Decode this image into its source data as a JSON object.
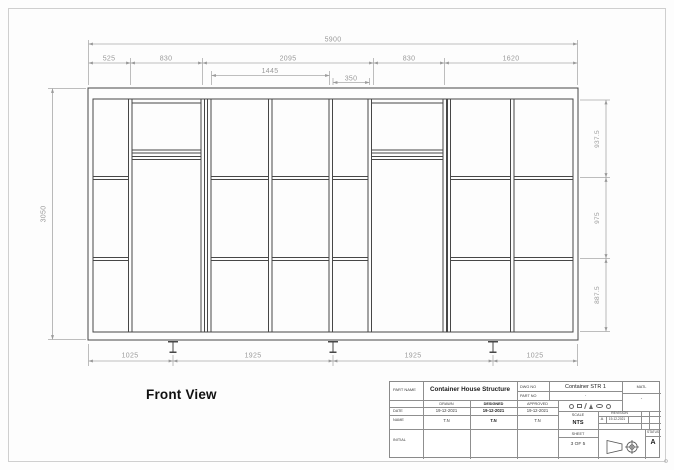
{
  "view": {
    "label": "Front View"
  },
  "dimensions": {
    "top_total": "5900",
    "top_segments": [
      "525",
      "830",
      "2095",
      "830",
      "1620"
    ],
    "sub_segments": [
      "1445",
      "350"
    ],
    "left_total": "3050",
    "right_segments": [
      "937.5",
      "975",
      "887.5"
    ],
    "bottom_segments": [
      "1025",
      "1925",
      "1925",
      "1025"
    ]
  },
  "title_block": {
    "part_name_label": "PART NAME",
    "part_name": "Container House Structure",
    "dwg_no_label": "DWG NO",
    "dwg_no": "Container STR 1",
    "part_no_label": "PART NO",
    "part_no": "-",
    "matl_label": "MATL",
    "matl_value": "-",
    "drawn_label": "DRAWN",
    "designed_label": "DESIGNED",
    "approved_label": "APPROVED",
    "date_label": "DATE",
    "drawn_date": "19-12-2021",
    "designed_date": "19-12-2021",
    "approved_date": "19-12-2021",
    "name_label": "NAME",
    "drawn_name": "T.N",
    "designed_name": "T.N",
    "approved_name": "T.N",
    "initial_label": "INITIAL",
    "scale_label": "SCALE",
    "scale_value": "NTS",
    "revision_label": "REVISION",
    "revision_value": "A",
    "revision_date": "19-12-2021",
    "sheet_label": "SHEET",
    "sheet_value": "3 OF 5",
    "status_label": "STATUS",
    "status_value": "A",
    "finish_symbols": [
      "circle",
      "square",
      "slash",
      "triangle",
      "ellipse",
      "circle"
    ]
  },
  "colors": {
    "structure_line": "#474747",
    "dimension_line": "#a8a8a8",
    "dimension_text": "#9a9a9a",
    "title_block_line": "#8a8a8a"
  }
}
